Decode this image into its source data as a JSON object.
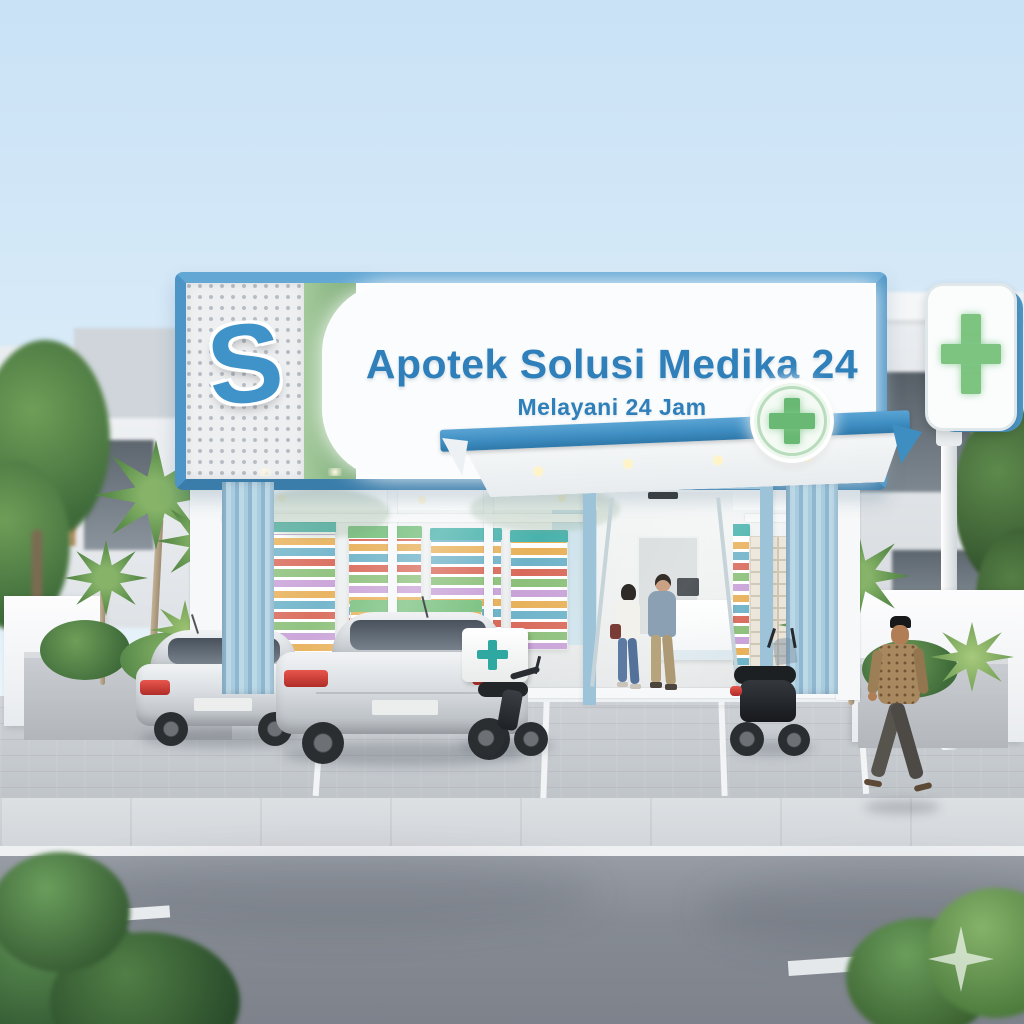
{
  "scene": {
    "type": "3d-architectural-render",
    "description": "24-hour pharmacy storefront exterior with parking, vehicles, customers and street",
    "watermark": "four-point sparkle, bottom right"
  },
  "signboard": {
    "title": "Apotek Solusi Medika 24",
    "subtitle": "Melayani 24 Jam",
    "logo_letter": "S"
  },
  "symbols": {
    "canopy_badge": "green-cross-in-circle",
    "pylon_sign": "green-cross",
    "delivery_box": "teal-cross"
  },
  "colors": {
    "sign_frame_blue": "#4c95c6",
    "title_blue": "#2e7fba",
    "accent_green_band": "#8ab87f",
    "cross_green": "#69b873",
    "delivery_cross_teal": "#2ea8a0",
    "louver_blue": "#a9ccdf",
    "canopy_blue": "#3f8ec2",
    "sky_blue": "#cfe6f7",
    "road_grey": "#84888f"
  }
}
